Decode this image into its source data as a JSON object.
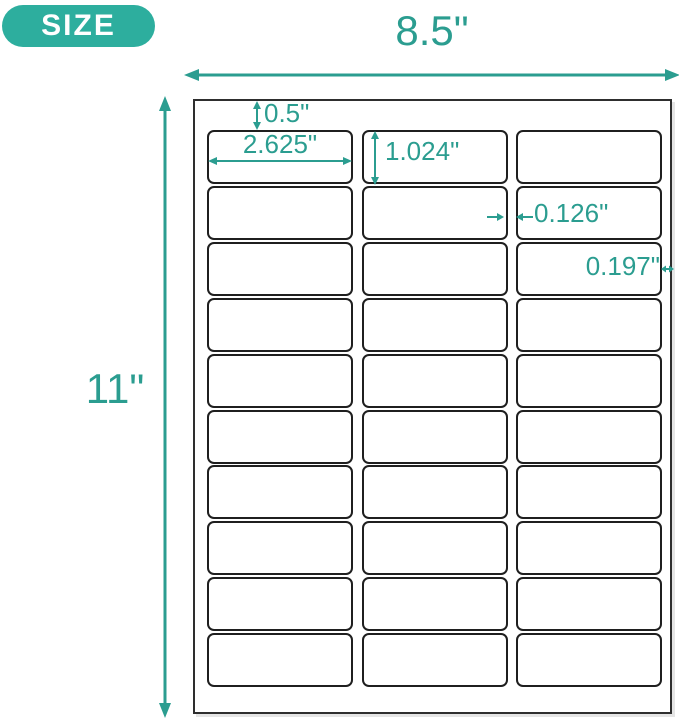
{
  "colors": {
    "accent": "#2B9D90",
    "badge_bg": "#2DAE9E",
    "badge_text": "#FFFFFF",
    "sheet_border": "#2E2E2E",
    "label_border": "#1F1F1F",
    "background": "#FFFFFF"
  },
  "badge": {
    "label": "SIZE"
  },
  "sheet": {
    "width_label": "8.5\"",
    "height_label": "11\"",
    "grid": {
      "rows": 10,
      "columns": 3,
      "total_labels": 30
    }
  },
  "annotations": {
    "top_margin": "0.5\"",
    "label_width": "2.625\"",
    "label_height": "1.024\"",
    "column_gap": "0.126\"",
    "right_margin": "0.197\""
  }
}
